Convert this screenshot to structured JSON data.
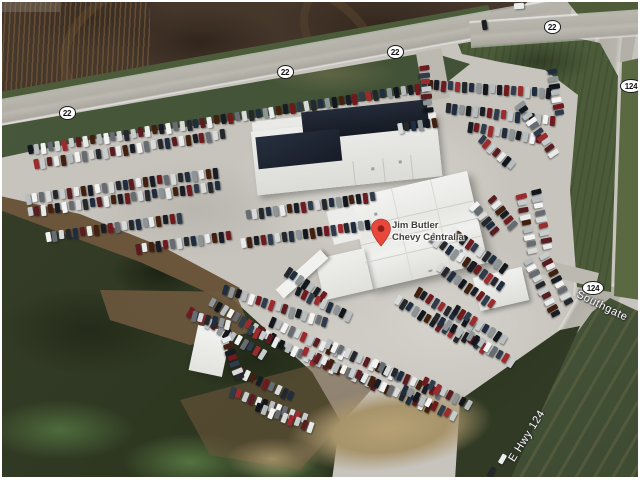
{
  "window": {
    "width": 640,
    "height": 480
  },
  "map": {
    "type": "satellite",
    "pin": {
      "label_line1": "Jim Butler",
      "label_line2": "Chevy Centralia"
    },
    "road_shields": [
      {
        "id": "shield-22-a",
        "text": "22",
        "x": 67,
        "y": 113
      },
      {
        "id": "shield-22-b",
        "text": "22",
        "x": 285,
        "y": 72
      },
      {
        "id": "shield-22-c",
        "text": "22",
        "x": 395,
        "y": 52
      },
      {
        "id": "shield-22-d",
        "text": "22",
        "x": 552,
        "y": 27
      },
      {
        "id": "shield-124-a",
        "text": "124",
        "x": 631,
        "y": 86
      },
      {
        "id": "shield-124-b",
        "text": "124",
        "x": 593,
        "y": 288
      }
    ],
    "road_labels": [
      {
        "id": "road-label-e-hwy-124",
        "text": "E Hwy 124",
        "x": 527,
        "y": 436,
        "angle": -58
      },
      {
        "id": "road-label-southgate",
        "text": "Southgate",
        "x": 602,
        "y": 306,
        "angle": 26
      }
    ],
    "colors": {
      "frame": "#ffffff",
      "lot": "#c7c4bd",
      "road": "#b3b0a8",
      "field": "#46372b",
      "grass": "#4c5c3a",
      "vegetation": "#2c361f",
      "sand": "#a8946b",
      "building": "#f0f0ee",
      "roof_dark": "#1e2430",
      "pin": "#e8473b",
      "pin_dot": "#8e2018",
      "label_text": "#413f3d",
      "road_label_text": "#fdfdfd"
    }
  }
}
